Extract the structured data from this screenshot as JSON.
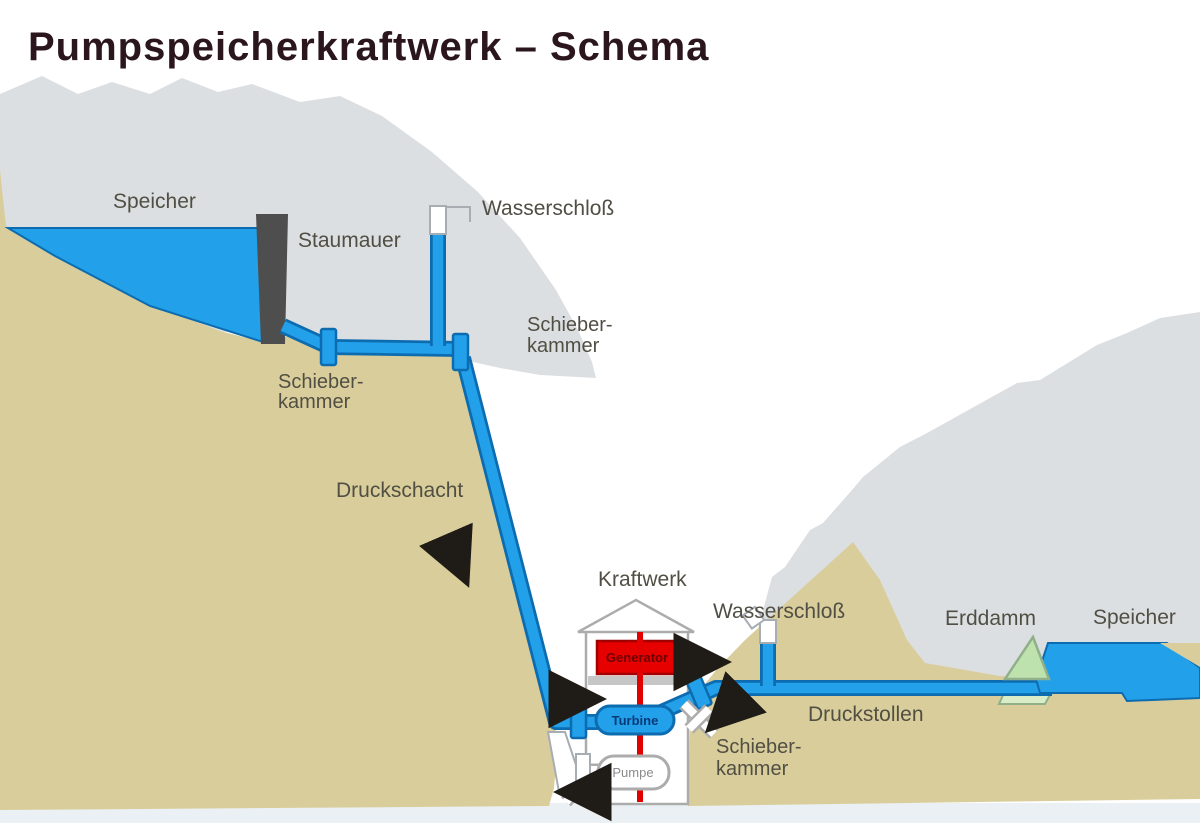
{
  "title": "Pumpspeicherkraftwerk – Schema",
  "labels": {
    "speicher_upper": "Speicher",
    "staumauer": "Staumauer",
    "wasserschloss_upper": "Wasserschloß",
    "schieberkammer_line1": "Schieber-",
    "schieberkammer_line2": "kammer",
    "druckschacht": "Druckschacht",
    "kraftwerk": "Kraftwerk",
    "wasserschloss_lower": "Wasserschloß",
    "erddamm": "Erddamm",
    "speicher_lower": "Speicher",
    "druckstollen": "Druckstollen",
    "generator": "Generator",
    "turbine": "Turbine",
    "pumpe": "Pumpe"
  },
  "colors": {
    "bg": "#FFFFFF",
    "mountain_gray": "#DCDFE2",
    "mountain_tan": "#D9CE9B",
    "bottom_strip": "#EAF0F4",
    "pipe_fill": "#22A0EA",
    "pipe_outline": "#0D6CB0",
    "dam_gray": "#4E4E4E",
    "generator_red": "#E60000",
    "generator_border": "#A00000",
    "generator_text": "#6E0000",
    "shaft_red": "#E30000",
    "turbine_text": "#083A78",
    "pumpe_text": "#8A8A8A",
    "erddamm_green": "#BEE2AE",
    "erddamm_outline": "#8FB08A",
    "erddamm_light": "#D8EDC8",
    "house_outline": "#ACACAC",
    "band_gray": "#C6C6C6",
    "label": "#514F44",
    "title": "#2A161C",
    "arrow": "#1F1B16"
  }
}
